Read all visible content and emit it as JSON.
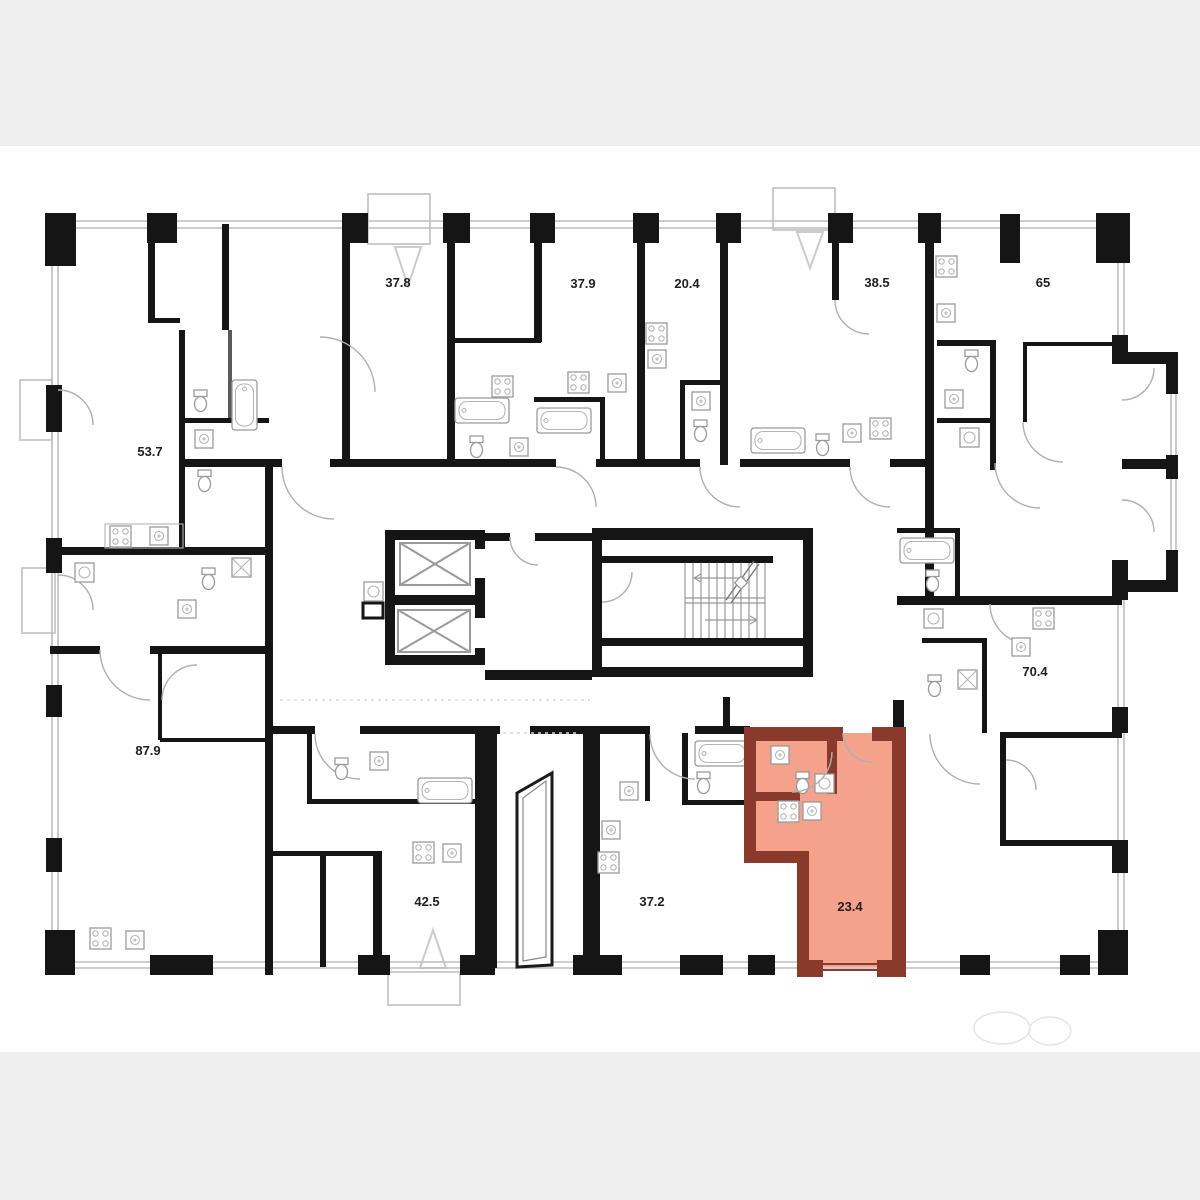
{
  "floorplan": {
    "type": "residential-building-floor-plan",
    "units": [
      {
        "area": "53.7"
      },
      {
        "area": "37.8"
      },
      {
        "area": "37.9"
      },
      {
        "area": "20.4"
      },
      {
        "area": "38.5"
      },
      {
        "area": "65"
      },
      {
        "area": "87.9"
      },
      {
        "area": "42.5"
      },
      {
        "area": "37.2"
      },
      {
        "area": "70.4"
      }
    ],
    "selected": {
      "area": "23.4",
      "fill_color": "#f4a28c",
      "wall_color": "#8a3a2b",
      "label_color": "#7c2f1f"
    },
    "colors": {
      "walls": "#151515",
      "thin_partitions": "#8a8a8a",
      "window_lines": "#bdbdbd",
      "balcony_lines": "#cccccc",
      "page_band": "#efefef",
      "canvas": "#ffffff"
    }
  }
}
